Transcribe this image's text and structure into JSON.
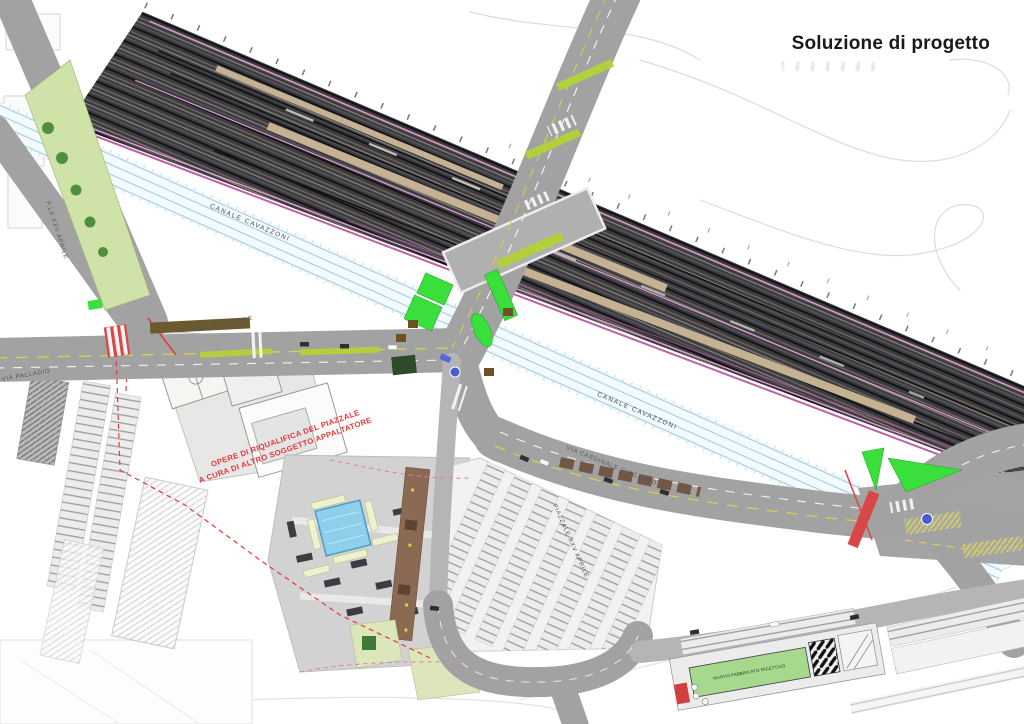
{
  "title": "Soluzione di progetto",
  "labels": {
    "canal": "CANALE  CAVAZZONI",
    "via_cardinale": "VIA CARDINALE GIROLAMO",
    "ple_xxv_aprile": "P.LE XXV APRILE",
    "via_palladio": "VIA PALLADIO",
    "piazzale_xxv_aprile": "PIAZZALE XXV APRILE",
    "note_line1": "OPERE DI RIQUALIFICA DEL PIAZZALE",
    "note_line2": "A CURA DI ALTRO SOGGETTO APPALTATORE",
    "building_bottom": "NUOVO FABBRICATO RICETTIVO"
  },
  "colors": {
    "background": "#ffffff",
    "ink": "#1a1a1a",
    "railway_dark": "#3b3b40",
    "track_line": "#141416",
    "platform_tan": "#c4b292",
    "rail_pink": "#e19fd0",
    "rail_magenta": "#c05fa8",
    "canal_fill": "#f3fafd",
    "canal_line": "#9ccade",
    "road": "#a2a2a2",
    "road_light": "#b5b5b5",
    "median_green": "#b2cf3c",
    "bright_green": "#3bdf3b",
    "lawn": "#dde6bb",
    "planter": "#eef1cd",
    "pool_blue": "#8ecfec",
    "promenade_brown": "#8a6a52",
    "tree_green": "#4e8f3e",
    "red_accent": "#e23b3b",
    "sign_blue": "#4c5cd0",
    "sketch": "#dcdcdc"
  }
}
